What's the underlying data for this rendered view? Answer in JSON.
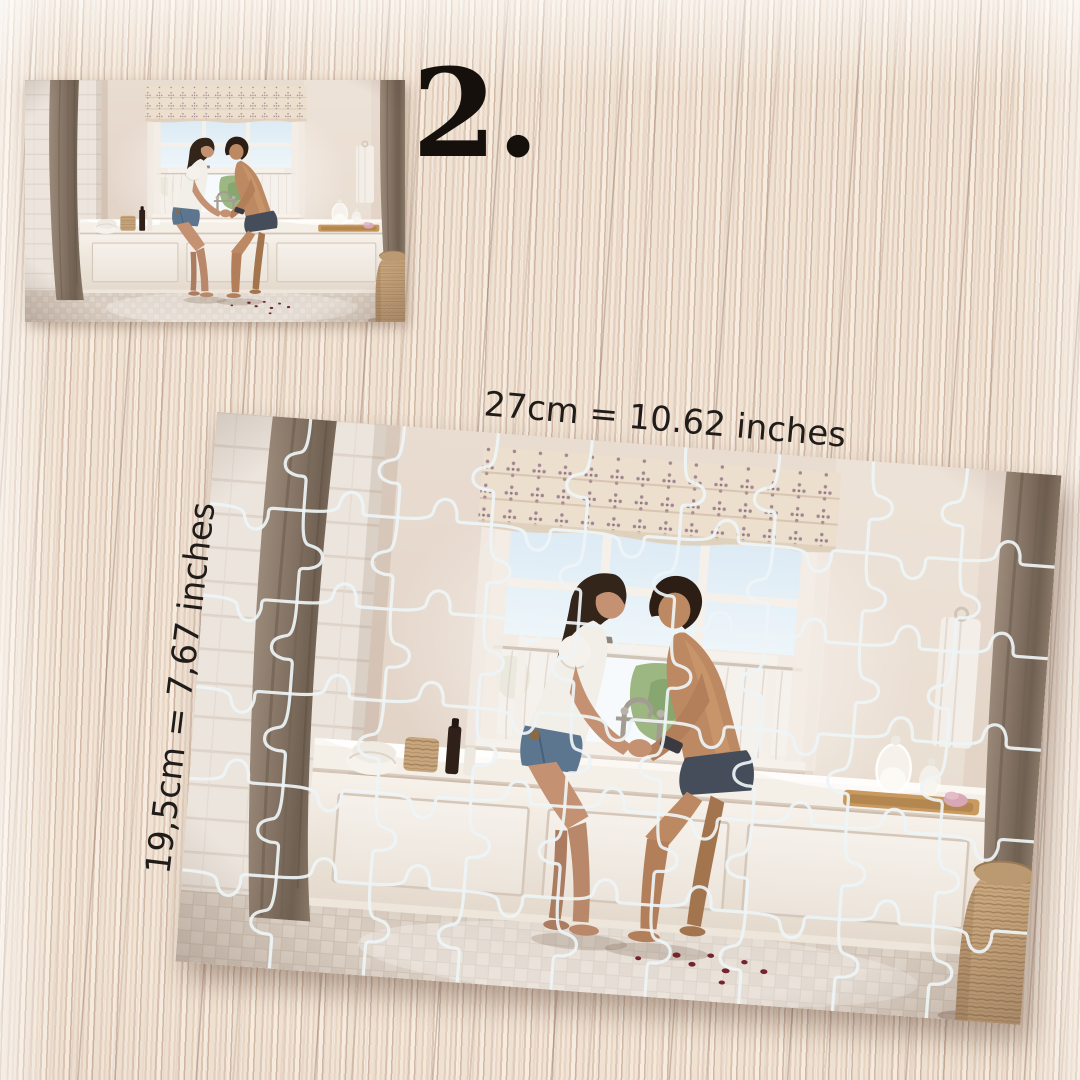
{
  "step": {
    "label": "2."
  },
  "puzzle": {
    "width_label": "27cm = 10.62 inches",
    "height_label": "19,5cm = 7,67 inches",
    "rows": 6,
    "cols": 9,
    "line_color": "#eef4f6",
    "line_width": 3.2
  },
  "scene": {
    "name": "couple-sitting-on-bathtub-edge-by-bright-window"
  },
  "colors": {
    "wood_base": "#e9d8c8",
    "wood_streak_dark": "#8f7164",
    "text": "#201c19",
    "step_text": "#16100c",
    "puzzle_line": "#eef4f6",
    "drape": "#837263",
    "wall": "#e5d8cc",
    "tub": "#f4efe7"
  }
}
